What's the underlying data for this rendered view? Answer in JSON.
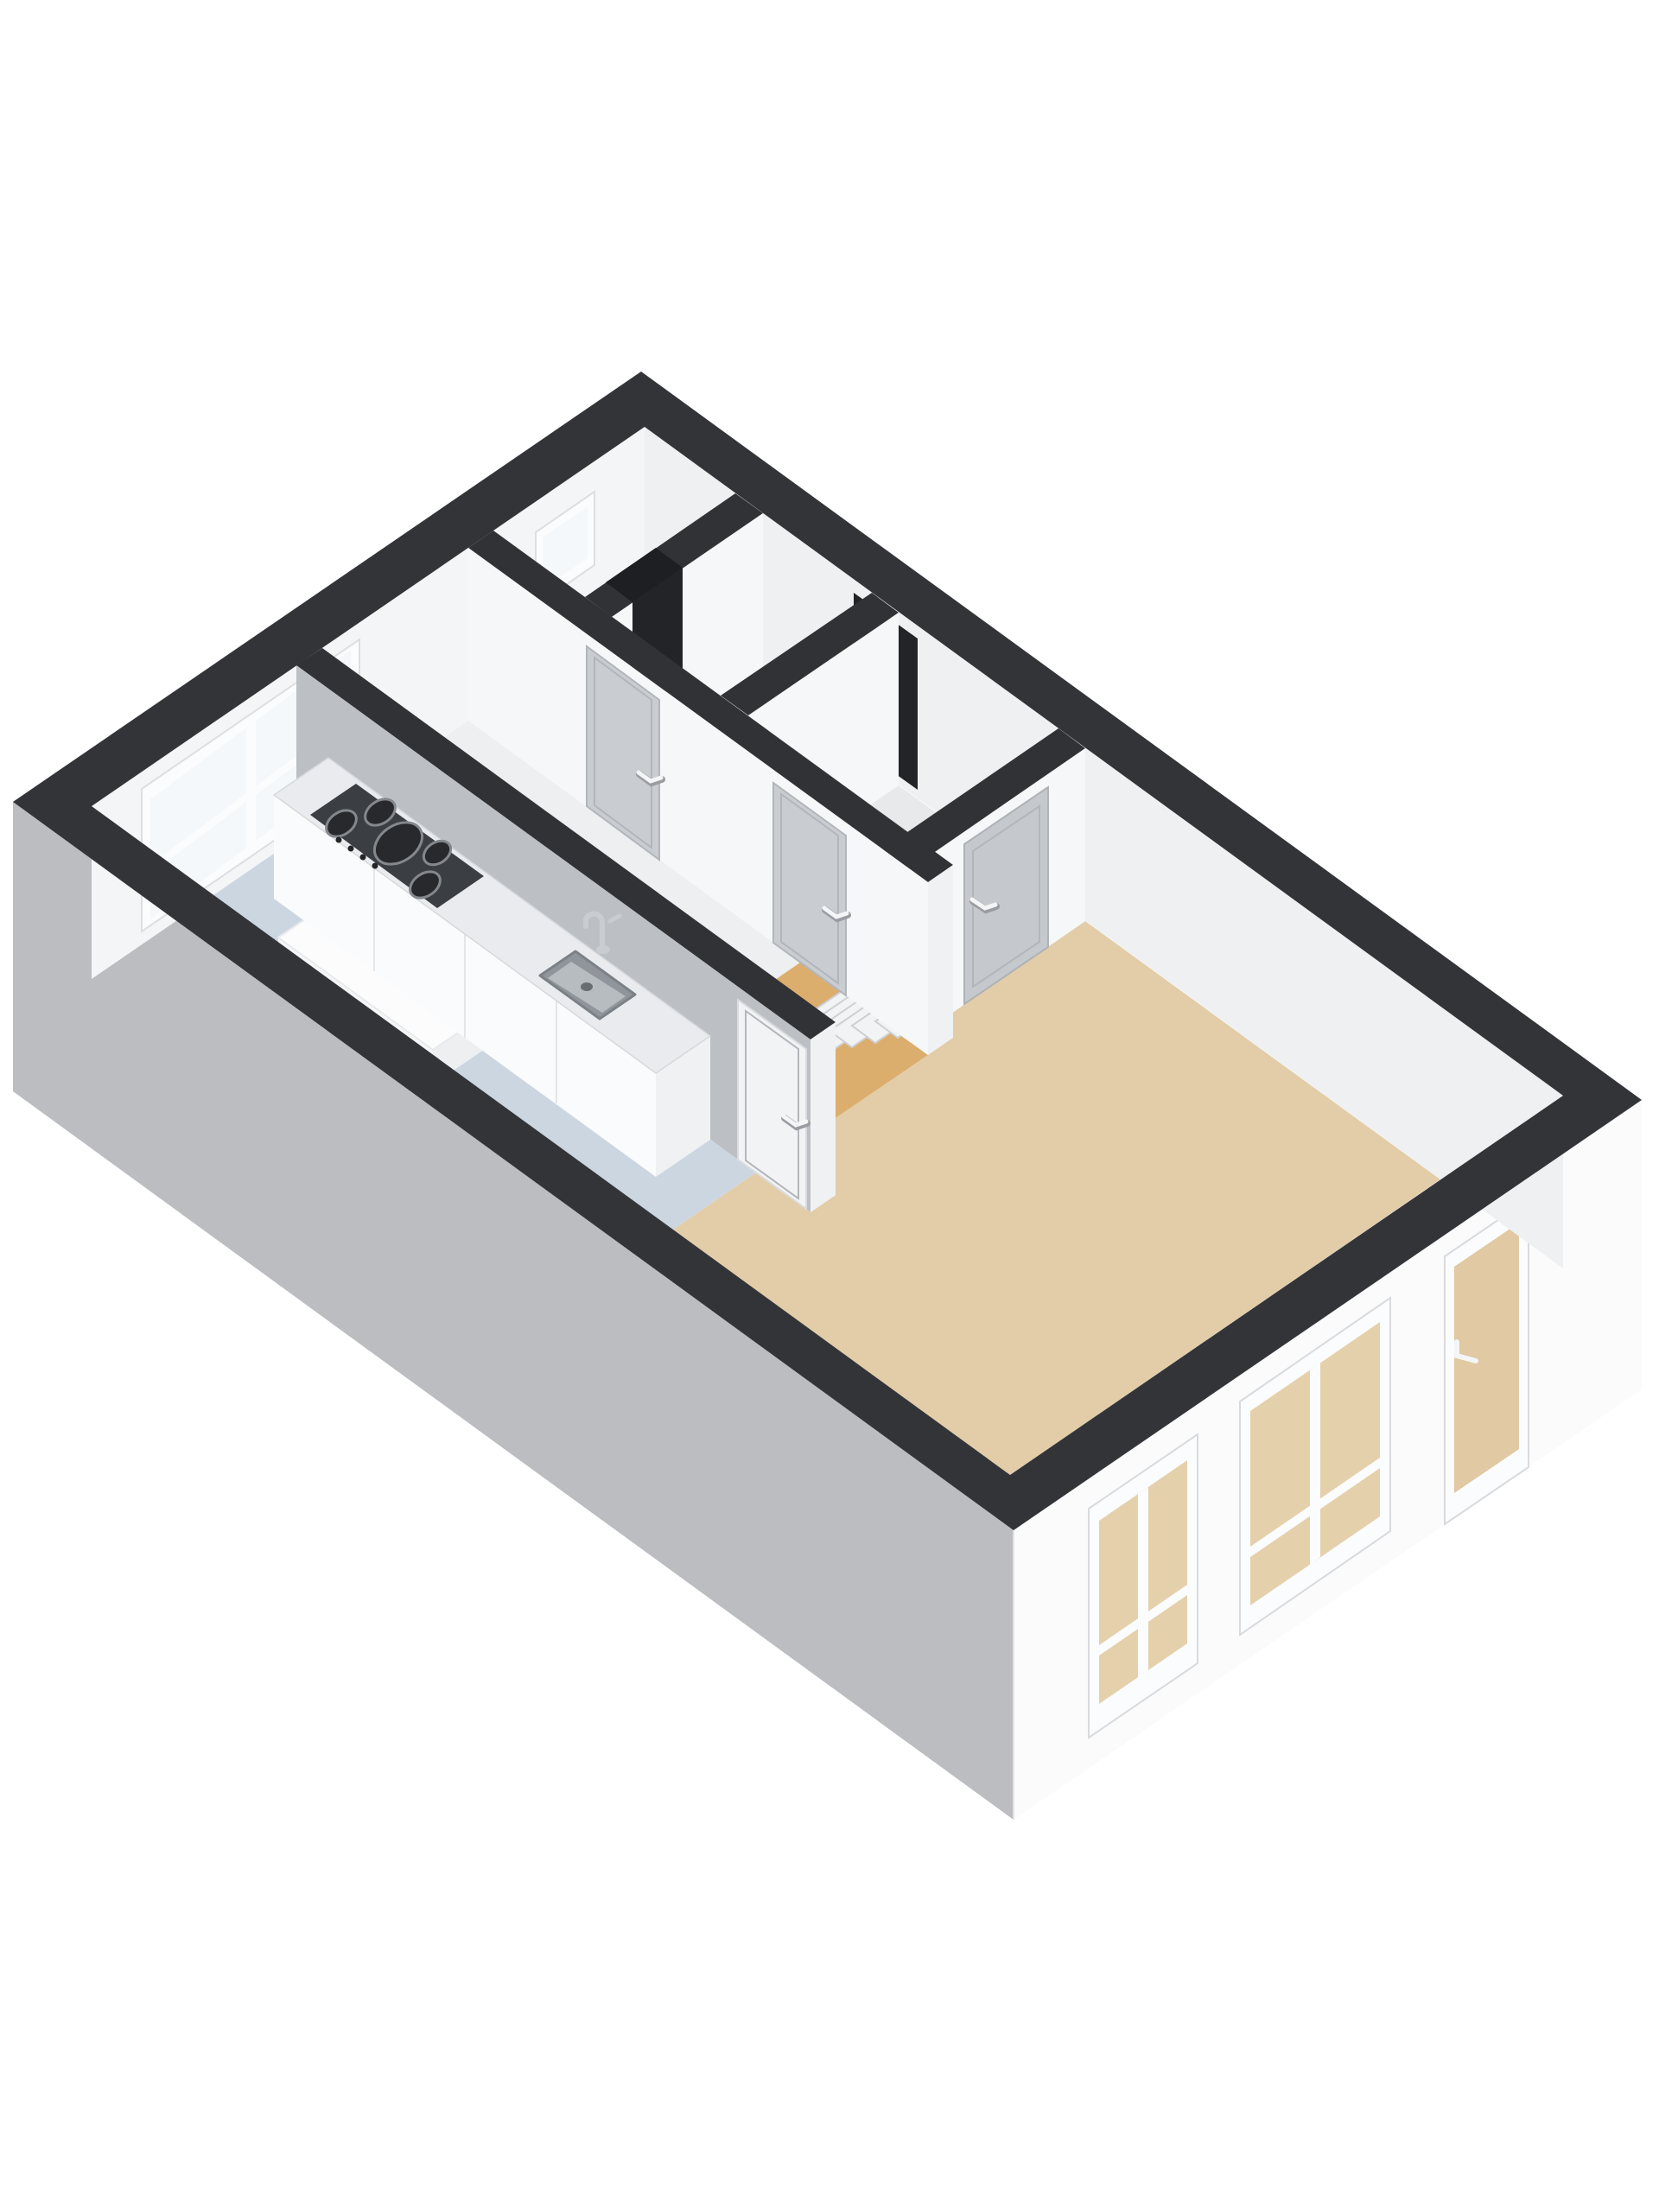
{
  "scene": {
    "type": "3d-floorplan-render",
    "view": "axonometric-top-down",
    "background": "#ffffff",
    "visible_text": ""
  },
  "colors": {
    "background": "#ffffff",
    "wall_cut": "#333438",
    "wall_cut_interior": "#313236",
    "exterior_left": "#bcbdc0",
    "exterior_front": "#fbfbfc",
    "exterior_corner_line": "#e3e3e5",
    "interior_wall_white": "#f6f7f8",
    "interior_wall_face": "#eff1f2",
    "interior_wall_gray": "#bcc0c5",
    "far_wall_left": "#f4f5f6",
    "far_wall_right": "#eef0f2",
    "floor_living": "#e3cda8",
    "floor_kitchen": "#ccd6e1",
    "floor_hall": "#edeff1",
    "floor_hall_accent": "#dcae6e",
    "floor_closet": "#eceef0",
    "floor_toilet": "#f0f1f3",
    "floor_stairwell": "#e7e9eb",
    "stair_tread": "#f2f3f5",
    "door_panel": "#c9cdd1",
    "door_panel_dark": "#c5c9cd",
    "door_panel_white": "#f2f3f5",
    "door_handle": "#f4f5f6",
    "door_handle_shadow": "#999da2",
    "opening_dark": "#232428",
    "void_dark": "#1e1f22",
    "window_frame": "#fbfcfd",
    "window_glass": "#f5f8fa",
    "window_pane_beige": "#e5d0ac",
    "window_pane_beige_dark": "#e0c9a3",
    "counter_top": "#e9ebee",
    "counter_front": "#fafbfc",
    "counter_end": "#eff1f3",
    "cooktop": "#3b3e42",
    "burner": "#27292c",
    "burner_ring": "#84888d",
    "knob": "#232528",
    "sink_rim": "#8f959b",
    "sink_basin": "#b7bcc1",
    "sink_drain": "#686d72",
    "faucet": "#c9cdd2",
    "appliance_white": "#fcfcfd",
    "appliance_front": "#f5f6f8",
    "appliance_end": "#edeff1"
  },
  "rooms": [
    {
      "name": "living-room",
      "floor_color_key": "floor_living"
    },
    {
      "name": "kitchen",
      "floor_color_key": "floor_kitchen",
      "fixtures": [
        "counter",
        "gas-cooktop",
        "sink",
        "faucet",
        "appliance-block"
      ]
    },
    {
      "name": "hallway",
      "floor_color_key": "floor_hall",
      "accent_floor_color_key": "floor_hall_accent"
    },
    {
      "name": "closet",
      "features": [
        "small-window",
        "open-doorway"
      ]
    },
    {
      "name": "toilet",
      "features": [
        "door"
      ]
    },
    {
      "name": "stairwell",
      "features": [
        "staircase",
        "door"
      ]
    }
  ],
  "openings": {
    "interior_doors": 4,
    "front_door_recess": 1,
    "facade_windows": 2,
    "facade_glazed_door": 1,
    "kitchen_window_panes": 2,
    "closet_window": 1
  },
  "stairs": {
    "visible_treads": 6,
    "direction": "ascending-to-back"
  }
}
